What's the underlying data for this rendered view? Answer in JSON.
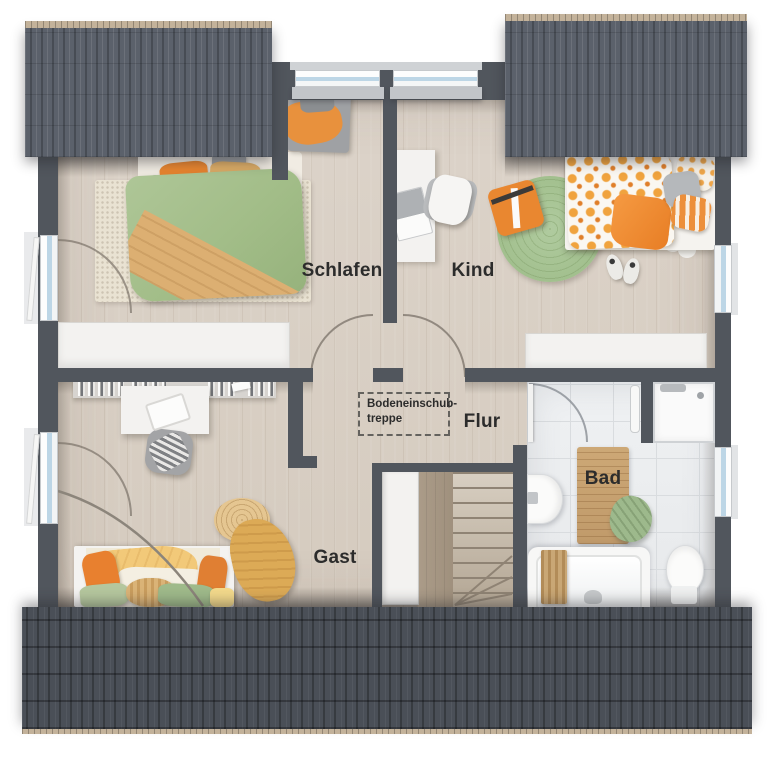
{
  "plan": {
    "title": "upper-floor-plan",
    "rooms": {
      "schlafen": {
        "label": "Schlafen"
      },
      "kind": {
        "label": "Kind"
      },
      "flur": {
        "label": "Flur"
      },
      "gast": {
        "label": "Gast"
      },
      "bad": {
        "label": "Bad"
      }
    },
    "attic_stairs": {
      "line1": "Bodeneinschub-",
      "line2": "treppe"
    }
  },
  "colors": {
    "wall": "#51565d",
    "roof_top": "#5b616b",
    "roof_bottom": "#4a4f57",
    "roof_ridge": "#c3b29a",
    "wood_floor": "#d8cfc4",
    "tile_floor": "#eceef0",
    "furniture_white": "#f3f2f0",
    "accent_orange": "#e8822e",
    "accent_green": "#a6c191",
    "accent_tan": "#d9a85f",
    "window_glass": "#bdd6e6",
    "label_ink": "#2c2c2c"
  }
}
